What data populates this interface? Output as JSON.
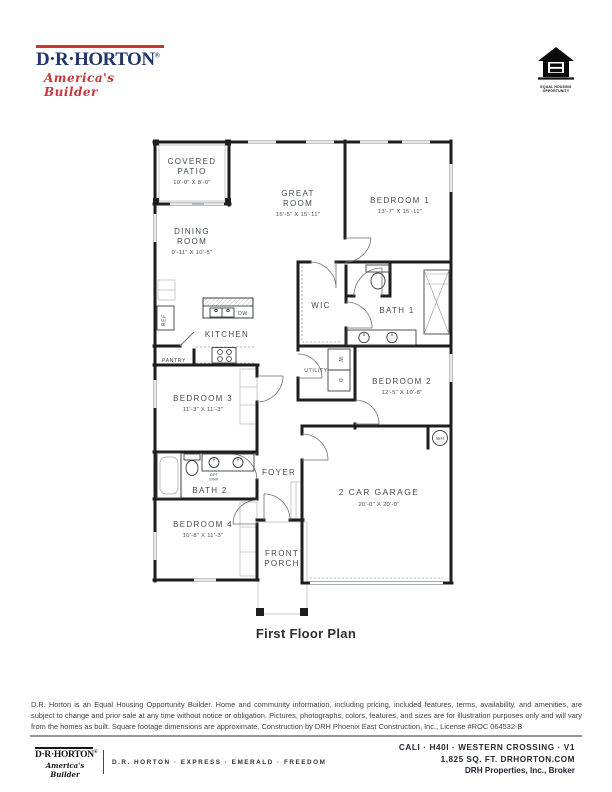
{
  "header": {
    "brand": "D·R·HORTON",
    "registered": "®",
    "tagline": "America's Builder",
    "equal_housing": {
      "line1": "EQUAL HOUSING",
      "line2": "OPPORTUNITY"
    }
  },
  "plan": {
    "caption": "First Floor Plan",
    "rooms": {
      "covered_patio": {
        "l1": "COVERED",
        "l2": "PATIO",
        "dims": "10'-0\" X 8'-0\""
      },
      "great_room": {
        "l1": "GREAT",
        "l2": "ROOM",
        "dims": "15'-5\" X 15'-11\""
      },
      "bedroom1": {
        "l1": "BEDROOM 1",
        "dims": "13'-7\" X 15'-11\""
      },
      "dining_room": {
        "l1": "DINING",
        "l2": "ROOM",
        "dims": "9'-11\" X 10'-5\""
      },
      "kitchen": {
        "l1": "KITCHEN"
      },
      "wic": {
        "l1": "WIC"
      },
      "bath1": {
        "l1": "BATH 1"
      },
      "utility": {
        "l1": "UTILITY"
      },
      "bedroom2": {
        "l1": "BEDROOM 2",
        "dims": "12'-5\" X 10'-8\""
      },
      "bedroom3": {
        "l1": "BEDROOM 3",
        "dims": "11'-3\" X 11'-3\""
      },
      "bath2": {
        "l1": "BATH 2"
      },
      "foyer": {
        "l1": "FOYER"
      },
      "bedroom4": {
        "l1": "BEDROOM 4",
        "dims": "10'-8\" X 11'-3\""
      },
      "front_porch": {
        "l1": "FRONT",
        "l2": "PORCH"
      },
      "garage": {
        "l1": "2 CAR GARAGE",
        "dims": "20'-0\" X 20'-0\""
      }
    },
    "labels": {
      "ref": "REF",
      "dw": "DW",
      "pantry": "PANTRY",
      "washer": "W",
      "dryer": "D",
      "wh": "WH",
      "opt1": "OPT",
      "opt2": "SINK"
    }
  },
  "disclaimer": "D.R. Horton is an Equal Housing Opportunity Builder. Home and community information, including pricing, included features, terms, availability, and amenities, are subject to change and prior sale at any time without notice or obligation. Pictures, photographs, colors, features, and sizes are for illustration purposes only and will vary from the homes as built. Square footage dimensions are approximate. Construction by DRH Phoenix East Construction, Inc., License #ROC 064532-B",
  "footer": {
    "brand": "D·R·HORTON",
    "registered": "®",
    "tagline": "America's Builder",
    "brands": "D.R. HORTON · EXPRESS · EMERALD · FREEDOM",
    "plan_code": "CALI · H40I · WESTERN CROSSING  · V1",
    "sqft": "1,825 SQ. FT.  DRHORTON.COM",
    "broker": "DRH Properties, Inc., Broker"
  },
  "colors": {
    "navy": "#23356d",
    "red": "#c8363d",
    "wall": "#1e1e1c",
    "label": "#45494f"
  }
}
